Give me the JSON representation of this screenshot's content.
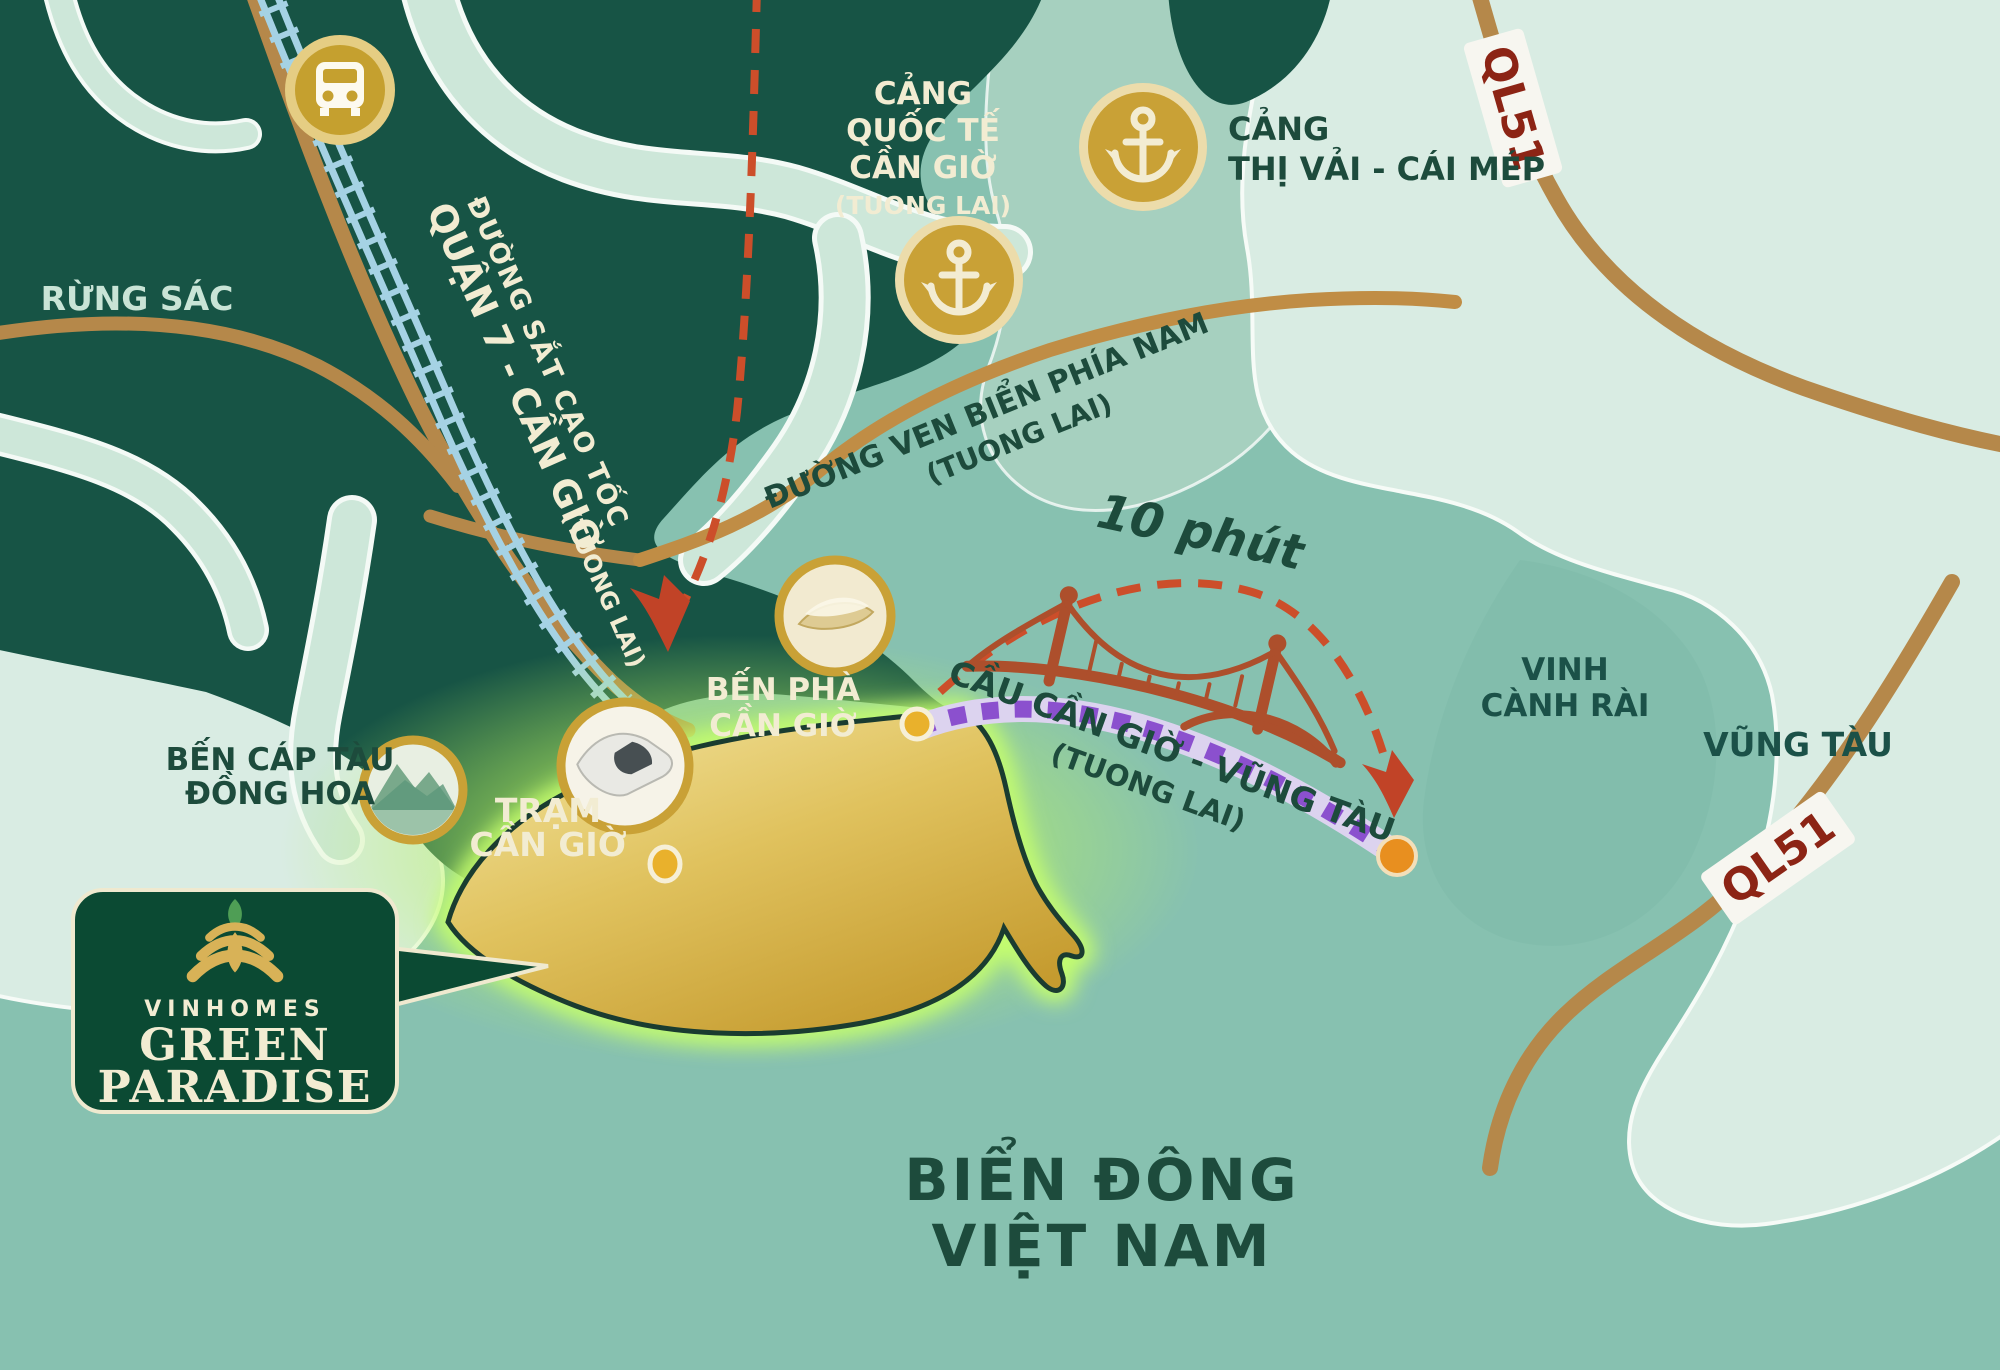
{
  "canvas": {
    "width": 2000,
    "height": 1370
  },
  "colors": {
    "sea": "#87c1b0",
    "dark_land": "#175445",
    "mint_land": "#d9ece3",
    "mid_teal": "#a6d0bf",
    "river": "#cde7d9",
    "road_brown": "#b5884a",
    "rail_blue": "#a5d2e4",
    "gold_icon": "#c9a136",
    "island_gold": "#d9b44a",
    "glow_green": "#b9f35f",
    "route_red": "#cc4e2a",
    "route_purple": "#8b50ce",
    "badge_green": "#0b4a33",
    "ql51_red": "#8c2415",
    "orange_dot": "#e88f1f"
  },
  "labels": {
    "forest": "RỪNG SÁC",
    "sea1": "BIỂN ĐÔNG",
    "sea2": "VIỆT NAM",
    "bay1": "VINH",
    "bay2": "CÀNH RÀI",
    "city": "VŨNG TÀU"
  },
  "railway_label": {
    "line1": "ĐƯỜNG SẮT CAO TỐC",
    "line2": "QUẬN 7 - CẦN GIỜ",
    "future": "(TUONG LAI)"
  },
  "ports": {
    "intl": {
      "line1": "CẢNG",
      "line2": "QUỐC TẾ",
      "line3": "CẦN GIỜ",
      "future": "(TUONG LAI)"
    },
    "thivai": {
      "line1": "CẢNG",
      "line2": "THỊ VẢI - CÁI MÉP"
    }
  },
  "roads": {
    "ql51": "QL51",
    "coastal1": "ĐƯỜNG VEN BIỂN PHÍA NAM",
    "coastal2": "(TUONG LAI)"
  },
  "bridge": {
    "time": "10 phút",
    "name": "CẦU CẦN GIỜ - VŨNG TÀU",
    "future": "(TUONG LAI)"
  },
  "stations": {
    "ferry1": "BẾN PHÀ",
    "ferry2": "CẦN GIỜ",
    "train1": "TRẠM",
    "train2": "CẦN GIỜ",
    "cable1": "BẾN CÁP TÀU",
    "cable2": "ĐỒNG HOA"
  },
  "badge": {
    "brand": "VINHOMES",
    "name1": "GREEN",
    "name2": "PARADISE"
  }
}
